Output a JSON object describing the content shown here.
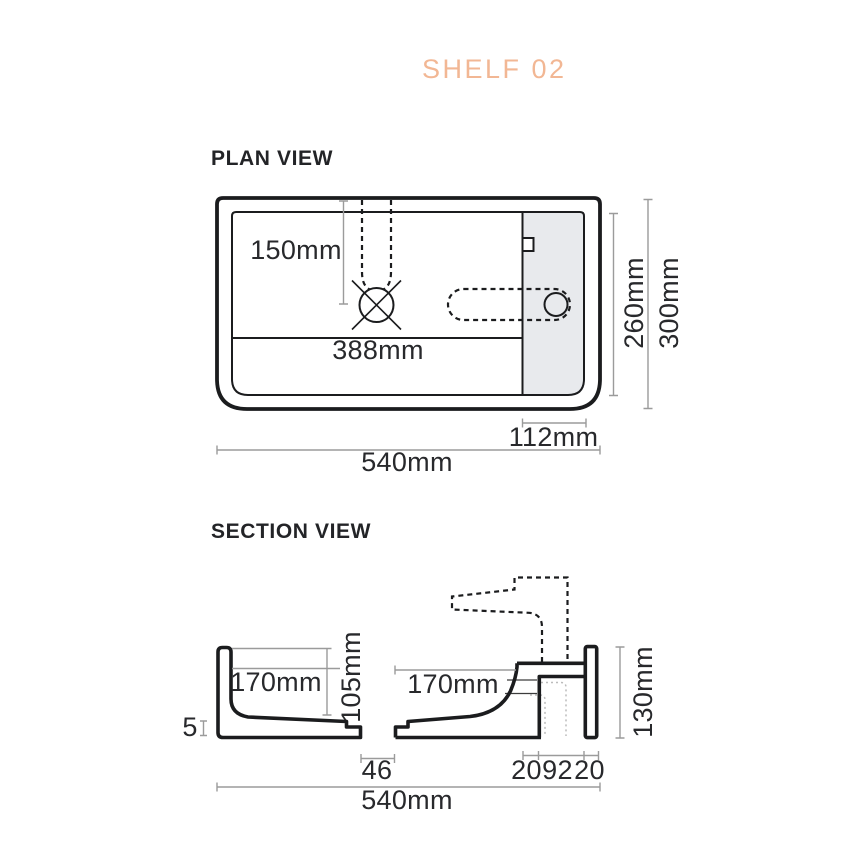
{
  "title": "SHELF 02",
  "plan_view": {
    "heading": "PLAN VIEW",
    "dimensions": {
      "tap_offset": "150mm",
      "basin_width": "388mm",
      "inner_depth": "260mm",
      "outer_depth": "300mm",
      "shelf_width": "112mm",
      "overall_width": "540mm"
    }
  },
  "section_view": {
    "heading": "SECTION VIEW",
    "dimensions": {
      "left_basin": "170mm",
      "basin_depth": "105mm",
      "right_basin": "170mm",
      "overall_height": "130mm",
      "base_thickness": "5",
      "drain_width": "46",
      "bracket_left": "20",
      "bracket_gap": "92",
      "bracket_right": "20",
      "overall_width": "540mm"
    }
  },
  "colors": {
    "accent": "#F2B794",
    "ink": "#1B1C1E",
    "dim_line": "#9B9B9B",
    "label_text": "#28292C",
    "shelf_shade": "#E8EAED"
  }
}
